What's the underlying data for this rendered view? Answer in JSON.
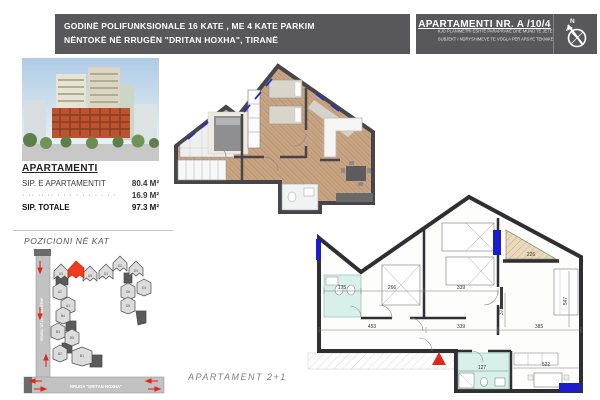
{
  "header": {
    "title_line1": "GODINË POLIFUNKSIONALE 16 KATE , ME 4 KATE PARKIM",
    "title_line2": "NËNTOKË NË RRUGËN \"DRITAN HOXHA\", TIRANË",
    "apartment_title": "APARTAMENTI NR. A /10/4",
    "disclaimer_line1": "KJO PLANIMETRI ËSHTË PARAPRAKE DHE MUND TË JETË",
    "disclaimer_line2": "SUBJEKT I NDRYSHIMEVE TË VOGLA PËR ARSYE TEKNIKE",
    "band_color": "#58585a",
    "compass_label": "N"
  },
  "apartment_info": {
    "heading": "APARTAMENTI",
    "rows": [
      {
        "label": "SIP. E APARTAMENTIT",
        "value": "80.4 M²"
      },
      {
        "label": "· ·· ·· ·· · · · · · · · · · ·",
        "value": "16.9 M²"
      },
      {
        "label": "SIP. TOTALE",
        "value": "97.3 M²"
      }
    ]
  },
  "position": {
    "title": "POZICIONI NË KAT",
    "street_vertical": "RRUGA \"AT ZEF VALENTINI\"",
    "street_horizontal": "RRUGA \"DRITAN HOXHA\"",
    "highlight_color": "#f03c1e",
    "units": [
      "A3",
      "A5",
      "D1",
      "D2",
      "D3",
      "D4",
      "D6",
      "D5",
      "A2",
      "A1",
      "B4",
      "B3",
      "B5",
      "B2",
      "B1"
    ]
  },
  "plans": {
    "caption": "APARTAMENT  2+1",
    "technical": {
      "dims": [
        "175",
        "266",
        "339",
        "453",
        "339",
        "385",
        "372",
        "547",
        "226",
        "127",
        "522"
      ]
    }
  }
}
